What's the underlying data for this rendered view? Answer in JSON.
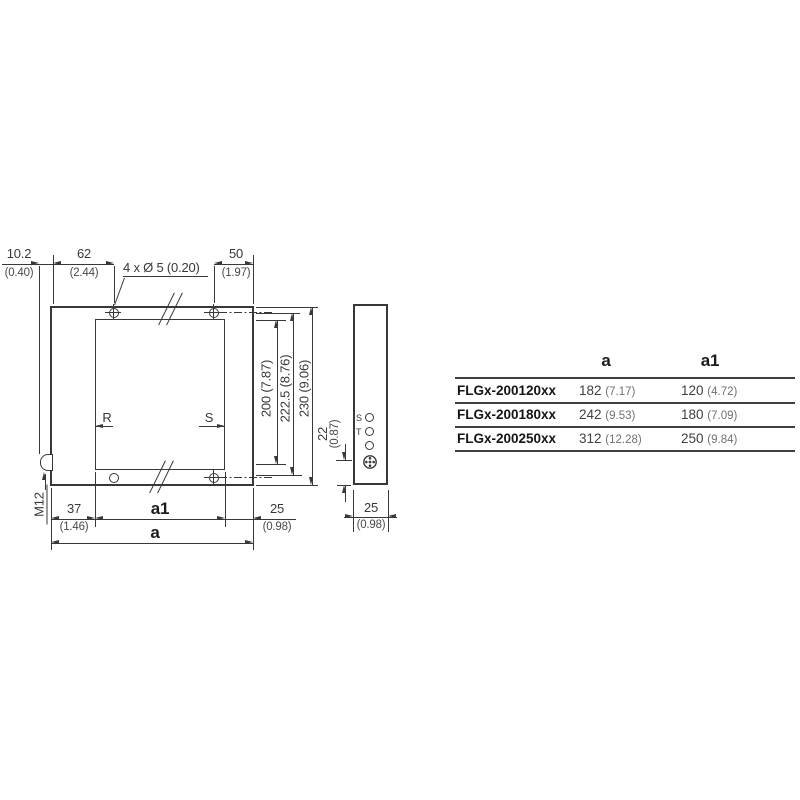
{
  "front": {
    "offset_mm": "10.2",
    "offset_in": "(0.40)",
    "hole_left_mm": "62",
    "hole_left_in": "(2.44)",
    "holes_note": "4 x Ø 5 (0.20)",
    "hole_right_mm": "50",
    "hole_right_in": "(1.97)",
    "beam_height": "200 (7.87)",
    "hole_pitch": "222.5 (8.76)",
    "total_height": "230 (9.06)",
    "connector_offset_mm": "22",
    "connector_offset_in": "(0.87)",
    "left_margin_mm": "37",
    "left_margin_in": "(1.46)",
    "aperture_width_label": "a1",
    "right_margin_mm": "25",
    "right_margin_in": "(0.98)",
    "total_width_label": "a",
    "connector_label": "M12",
    "receiver_label": "R",
    "sender_label": "S"
  },
  "side": {
    "led_s_label": "S",
    "led_t_label": "T",
    "depth_mm": "25",
    "depth_in": "(0.98)"
  },
  "table": {
    "col_a": "a",
    "col_a1": "a1",
    "rows": [
      {
        "model": "FLGx-200120xx",
        "a_mm": "182",
        "a_in": "(7.17)",
        "a1_mm": "120",
        "a1_in": "(4.72)"
      },
      {
        "model": "FLGx-200180xx",
        "a_mm": "242",
        "a_in": "(9.53)",
        "a1_mm": "180",
        "a1_in": "(7.09)"
      },
      {
        "model": "FLGx-200250xx",
        "a_mm": "312",
        "a_in": "(12.28)",
        "a1_mm": "250",
        "a1_in": "(9.84)"
      }
    ]
  },
  "colors": {
    "line": "#383838",
    "table_text": "#141414",
    "muted": "#707070"
  }
}
